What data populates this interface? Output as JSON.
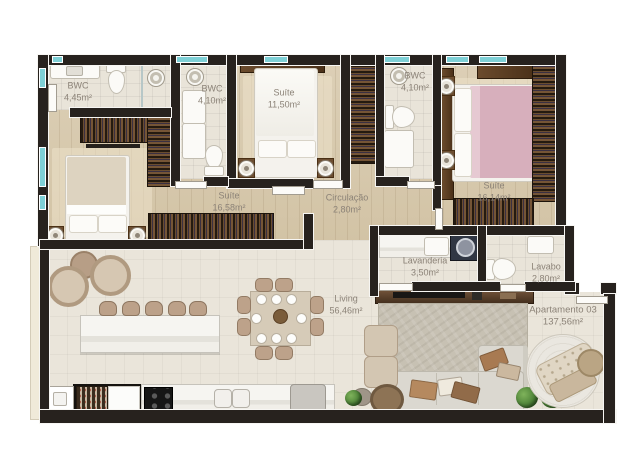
{
  "plan": {
    "unit": {
      "name": "Apartamento 03",
      "area": "137,56m²"
    },
    "rooms": [
      {
        "name": "BWC",
        "area": "4,45m²"
      },
      {
        "name": "BWC",
        "area": "4,10m²"
      },
      {
        "name": "Suíte",
        "area": "11,50m²"
      },
      {
        "name": "BWC",
        "area": "4,10m²"
      },
      {
        "name": "Suíte",
        "area": "16,14m²"
      },
      {
        "name": "Suíte",
        "area": "16,58m²"
      },
      {
        "name": "Circulação",
        "area": "2,80m²"
      },
      {
        "name": "Lavanderia",
        "area": "3,50m²"
      },
      {
        "name": "Lavabo",
        "area": "2,80m²"
      },
      {
        "name": "Living",
        "area": "56,46m²"
      }
    ],
    "colors": {
      "wall": "#27221e",
      "window_glass": "#7ed0d6",
      "wood_floor": "#d8caae",
      "tile_floor": "#e9e4d9",
      "wardrobe_wood": "#4a3420",
      "bed_linen": "#f4f2ed",
      "accent_pink_bed": "#d9b2bf",
      "plant_green": "#4e8338",
      "label_text": "#8b8277"
    }
  }
}
